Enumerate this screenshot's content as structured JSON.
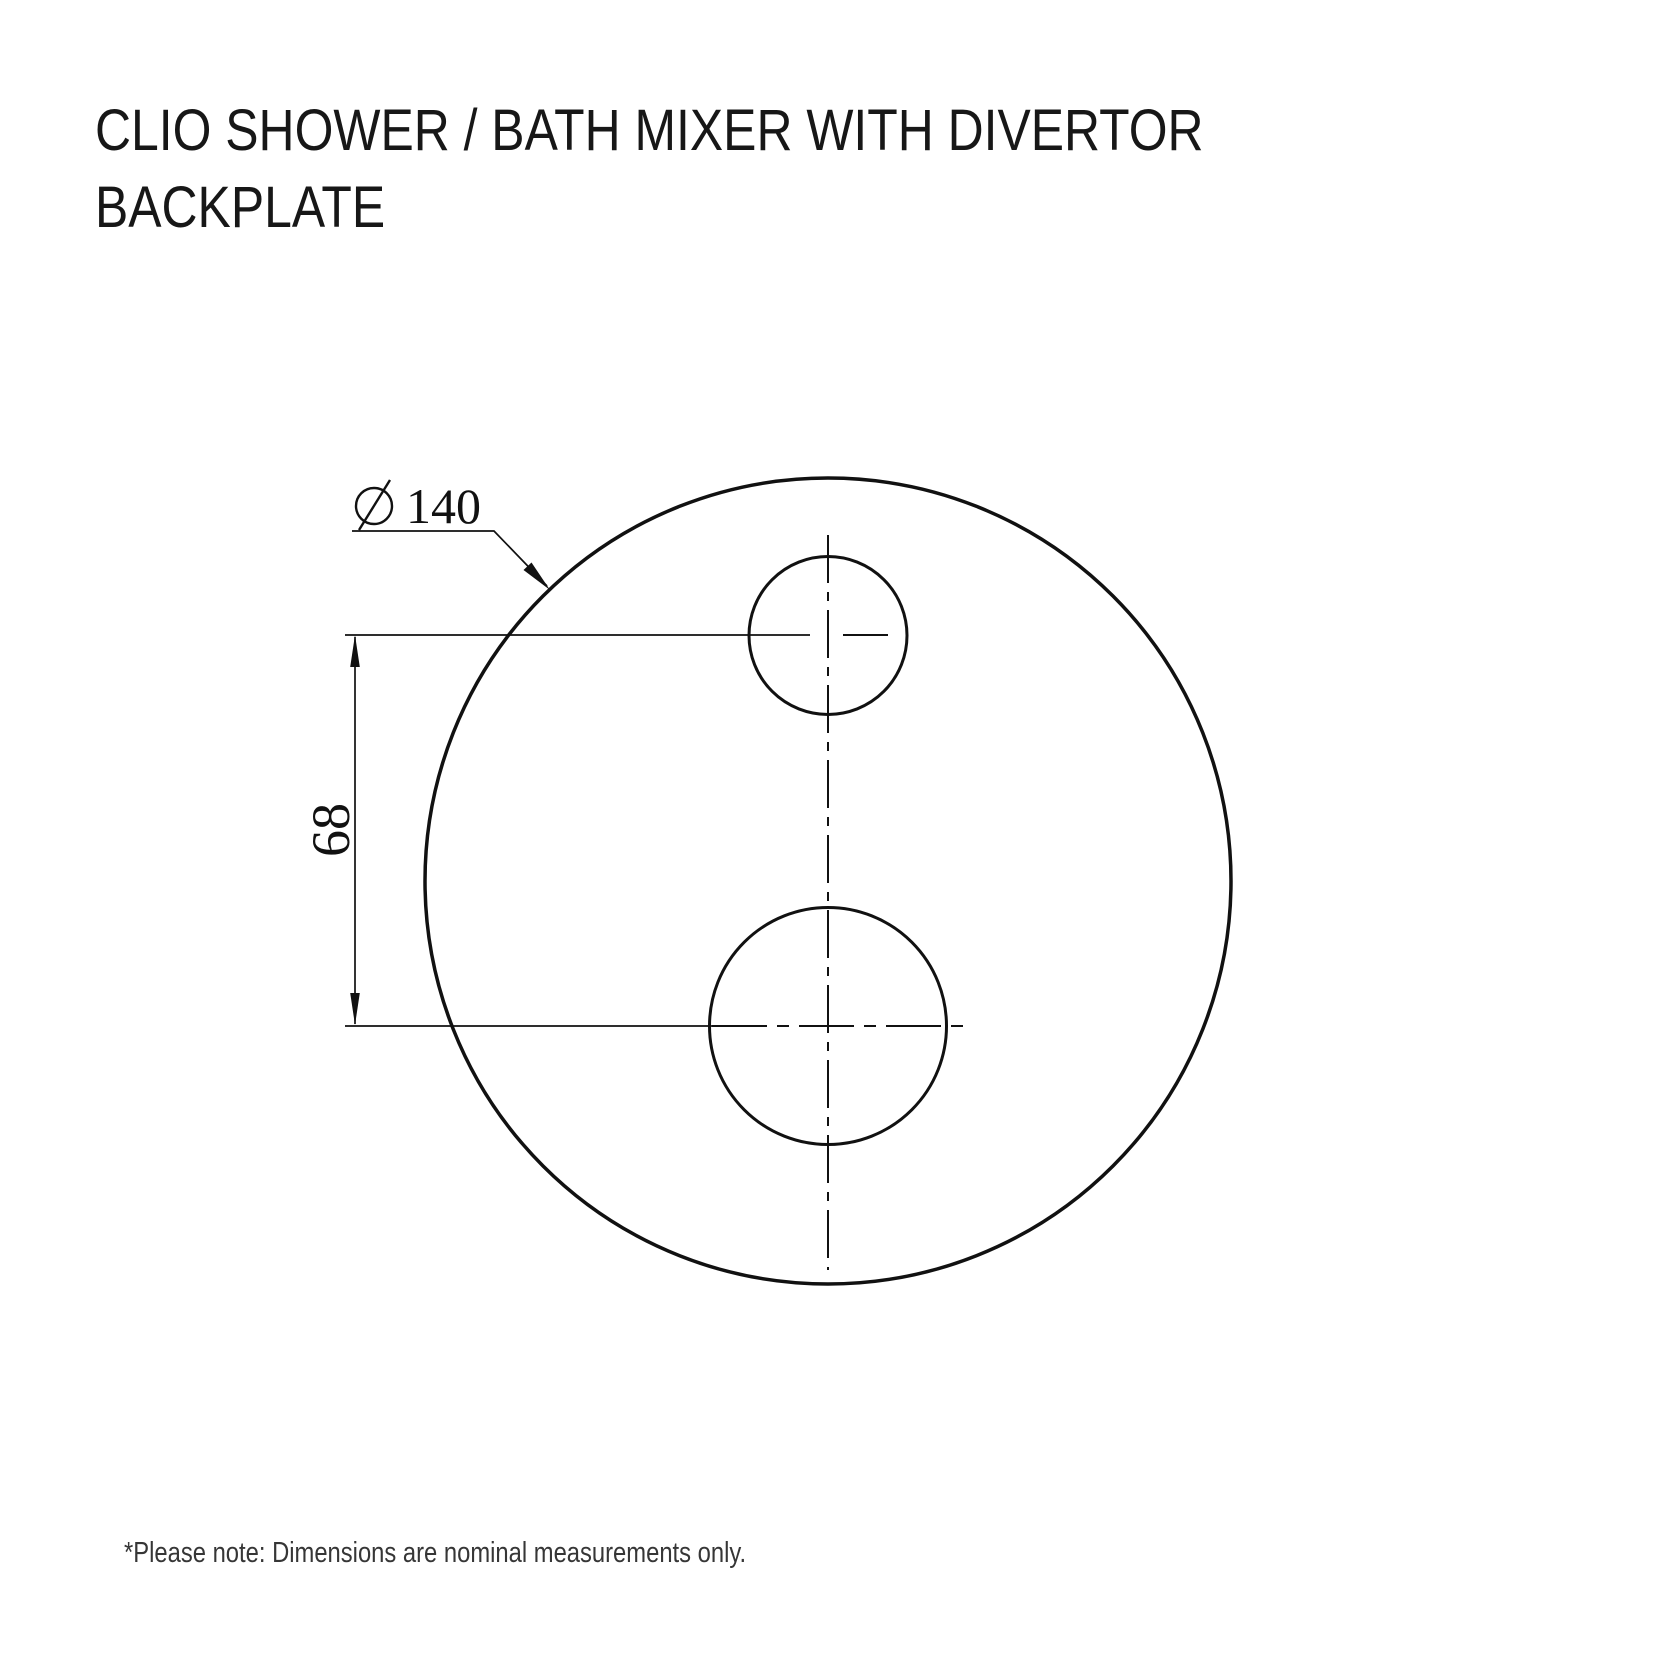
{
  "title": {
    "line1": "CLIO SHOWER / BATH MIXER WITH DIVERTOR",
    "line2": "BACKPLATE"
  },
  "note": "*Please note: Dimensions are nominal measurements only.",
  "drawing": {
    "line_color": "#111111",
    "diameter_symbol": "⌀",
    "diameter_value": "140",
    "vertical_dimension_value": "68",
    "backplate_circle": {
      "cx": 828,
      "cy": 881,
      "r": 403
    },
    "top_hole": {
      "cx": 828,
      "cy": 635,
      "r": 79
    },
    "bottom_hole": {
      "cx": 828,
      "cy": 1026,
      "r": 118
    }
  }
}
